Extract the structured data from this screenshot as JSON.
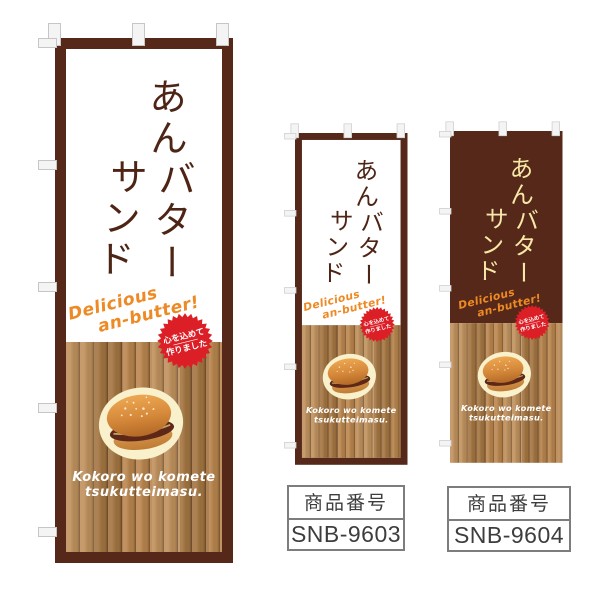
{
  "page": {
    "background": "#ffffff"
  },
  "colors": {
    "page_bg": "#ffffff",
    "frame_brown": "#55281a",
    "title_brown": "#4e2415",
    "title_cream": "#f6e9a8",
    "tagline_orange": "#ee8a25",
    "badge_red": "#dc1e26",
    "caption_white": "#ffffff",
    "wood_light": "#c0905c",
    "wood_mid": "#a97943",
    "wood_dark": "#8a6238",
    "wood_line": "#6e4b28",
    "label_text": "#3d3d3d",
    "label_border": "#7d7d7d"
  },
  "banner_text": {
    "title_col_right": "あんバター",
    "title_col_left": "サンド",
    "tagline_line1": "Delicious",
    "tagline_line2": "an-butter!",
    "badge_line1": "心を込めて",
    "badge_line2": "作りました",
    "caption_line1": "Kokoro wo komete",
    "caption_line2": "tsukutteimasu."
  },
  "banners": [
    {
      "name": "large-nobori",
      "variant": "white-top-framed"
    },
    {
      "name": "small-nobori-snb-9603",
      "variant": "white-top-framed"
    },
    {
      "name": "small-nobori-snb-9604",
      "variant": "brown-top-frameless"
    }
  ],
  "labels": [
    {
      "heading": "商品番号",
      "code": "SNB-9603"
    },
    {
      "heading": "商品番号",
      "code": "SNB-9604"
    }
  ]
}
